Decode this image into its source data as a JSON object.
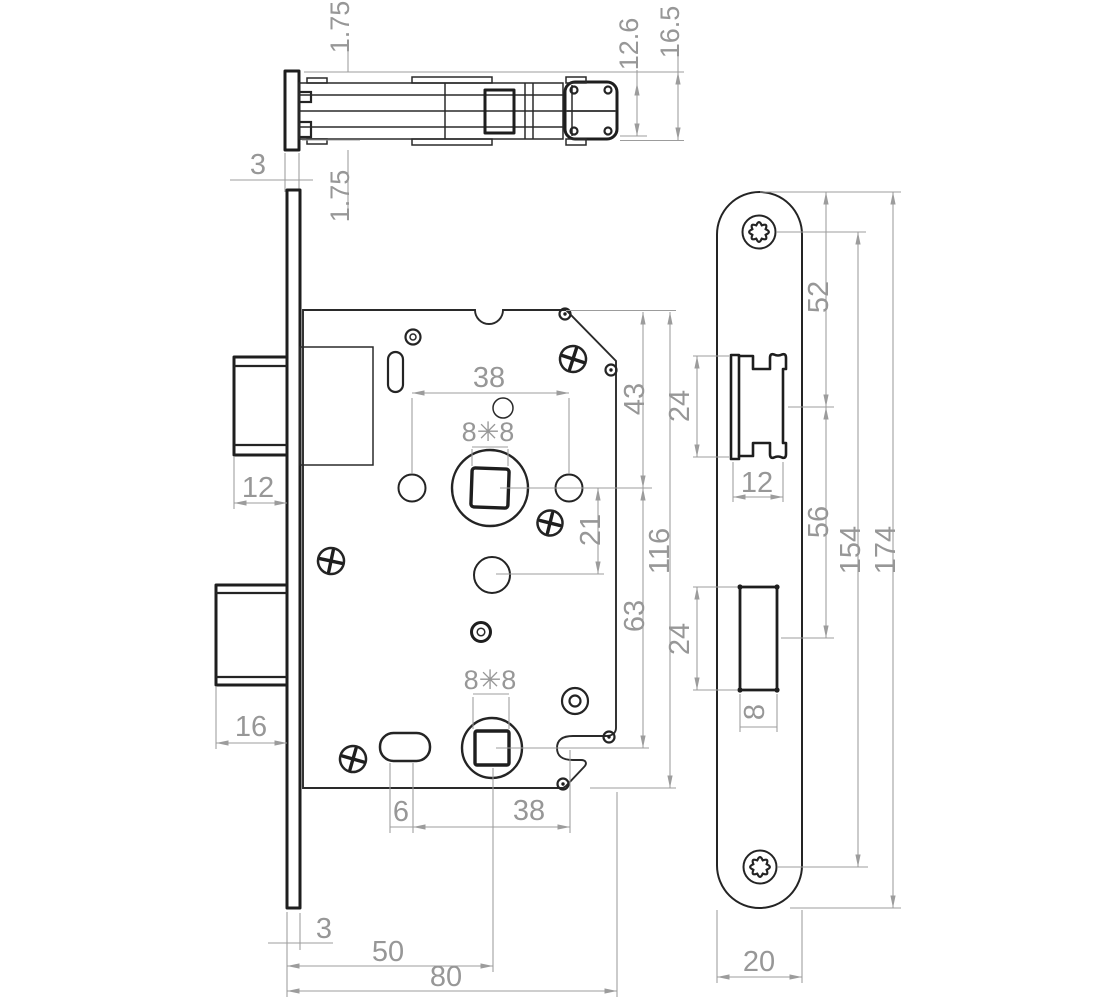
{
  "colors": {
    "line": "#242424",
    "dim": "#9c9c9c",
    "background": "#ffffff"
  },
  "views": {
    "top_section": {
      "flange_offset_top": "1.75",
      "latch_body_height": "12.6",
      "overall_height": "16.5",
      "faceplate_thickness": "3",
      "flange_offset_bottom": "1.75"
    },
    "lock_case": {
      "hub_to_hub": "38",
      "spindle_square_top": "8✳8",
      "top_edge_to_spindle": "43",
      "latch_bolt_width": "12",
      "spindle_to_cylinder": "21",
      "case_height": "116",
      "spindle_to_bottom_hub": "63",
      "deadbolt_width": "16",
      "spindle_square_bottom": "8✳8",
      "slot_width": "6",
      "slot_to_spindle": "38",
      "faceplate_thickness": "3",
      "backset": "50",
      "case_depth": "80"
    },
    "faceplate": {
      "top_to_latch_center": "52",
      "latch_cutout_height": "24",
      "latch_cutout_width": "12",
      "latch_to_deadbolt_center": "56",
      "screw_center_spacing": "154",
      "overall_length": "174",
      "deadbolt_cutout_height": "24",
      "deadbolt_cutout_width": "8",
      "plate_width": "20"
    }
  }
}
